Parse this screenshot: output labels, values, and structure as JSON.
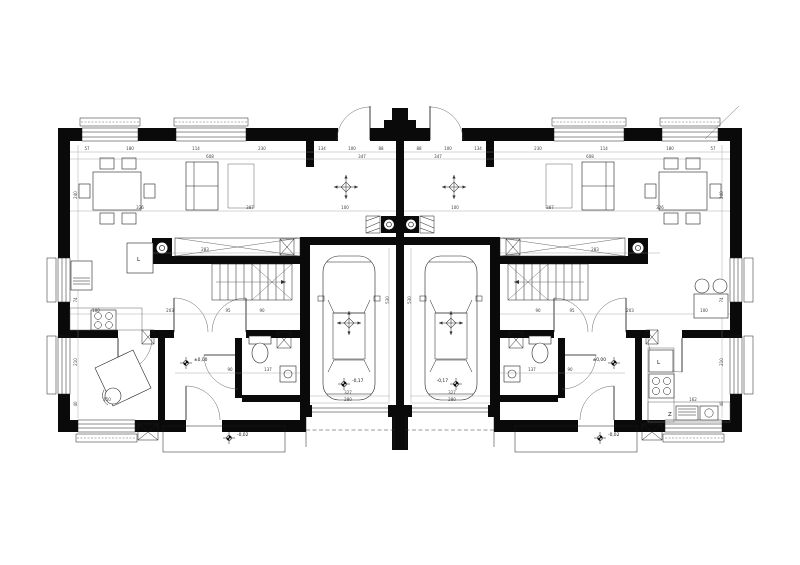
{
  "plan": {
    "labels": {
      "kitchen_cabinet_left": "L",
      "kitchen_cabinet_right": "L",
      "appliance_right": "Z"
    },
    "level_markers": [
      {
        "x": 186,
        "y": 363,
        "text": "±0,00",
        "side": "r"
      },
      {
        "x": 614,
        "y": 363,
        "text": "±0,00",
        "side": "l"
      },
      {
        "x": 229,
        "y": 438,
        "text": "-0,02",
        "side": "r"
      },
      {
        "x": 600,
        "y": 438,
        "text": "-0,02",
        "side": "r"
      },
      {
        "x": 344,
        "y": 384,
        "text": "-0,17",
        "side": "r"
      },
      {
        "x": 456,
        "y": 384,
        "text": "-0,17",
        "side": "l"
      }
    ],
    "dim_labels": [
      {
        "x": 87,
        "y": 150,
        "t": "57"
      },
      {
        "x": 130,
        "y": 150,
        "t": "180"
      },
      {
        "x": 196,
        "y": 150,
        "t": "114"
      },
      {
        "x": 262,
        "y": 150,
        "t": "230"
      },
      {
        "x": 322,
        "y": 150,
        "t": "134"
      },
      {
        "x": 352,
        "y": 150,
        "t": "100"
      },
      {
        "x": 381,
        "y": 150,
        "t": "88"
      },
      {
        "x": 419,
        "y": 150,
        "t": "88"
      },
      {
        "x": 448,
        "y": 150,
        "t": "100"
      },
      {
        "x": 478,
        "y": 150,
        "t": "134"
      },
      {
        "x": 538,
        "y": 150,
        "t": "230"
      },
      {
        "x": 604,
        "y": 150,
        "t": "114"
      },
      {
        "x": 670,
        "y": 150,
        "t": "180"
      },
      {
        "x": 713,
        "y": 150,
        "t": "57"
      },
      {
        "x": 210,
        "y": 158,
        "t": "608"
      },
      {
        "x": 362,
        "y": 158,
        "t": "347"
      },
      {
        "x": 438,
        "y": 158,
        "t": "347"
      },
      {
        "x": 590,
        "y": 158,
        "t": "608"
      },
      {
        "x": 140,
        "y": 209,
        "t": "326"
      },
      {
        "x": 250,
        "y": 209,
        "t": "387"
      },
      {
        "x": 345,
        "y": 209,
        "t": "100"
      },
      {
        "x": 455,
        "y": 209,
        "t": "100"
      },
      {
        "x": 550,
        "y": 209,
        "t": "387"
      },
      {
        "x": 660,
        "y": 209,
        "t": "326"
      },
      {
        "x": 205,
        "y": 251,
        "t": "283"
      },
      {
        "x": 595,
        "y": 251,
        "t": "283"
      },
      {
        "x": 96,
        "y": 312,
        "t": "100"
      },
      {
        "x": 170,
        "y": 312,
        "t": "203"
      },
      {
        "x": 228,
        "y": 312,
        "t": "95"
      },
      {
        "x": 262,
        "y": 312,
        "t": "90"
      },
      {
        "x": 538,
        "y": 312,
        "t": "90"
      },
      {
        "x": 572,
        "y": 312,
        "t": "95"
      },
      {
        "x": 630,
        "y": 312,
        "t": "203"
      },
      {
        "x": 704,
        "y": 312,
        "t": "100"
      },
      {
        "x": 230,
        "y": 371,
        "t": "90"
      },
      {
        "x": 268,
        "y": 371,
        "t": "137"
      },
      {
        "x": 532,
        "y": 371,
        "t": "137"
      },
      {
        "x": 570,
        "y": 371,
        "t": "90"
      },
      {
        "x": 107,
        "y": 401,
        "t": "150"
      },
      {
        "x": 693,
        "y": 401,
        "t": "162"
      },
      {
        "x": 348,
        "y": 394,
        "t": "327"
      },
      {
        "x": 452,
        "y": 394,
        "t": "327"
      },
      {
        "x": 348,
        "y": 401,
        "t": "280"
      },
      {
        "x": 452,
        "y": 401,
        "t": "280"
      },
      {
        "x": 77,
        "y": 195,
        "t": "240",
        "r": true
      },
      {
        "x": 77,
        "y": 300,
        "t": "74",
        "r": true
      },
      {
        "x": 77,
        "y": 362,
        "t": "210",
        "r": true
      },
      {
        "x": 77,
        "y": 404,
        "t": "40",
        "r": true
      },
      {
        "x": 723,
        "y": 195,
        "t": "240",
        "r": true
      },
      {
        "x": 723,
        "y": 300,
        "t": "74",
        "r": true
      },
      {
        "x": 723,
        "y": 362,
        "t": "210",
        "r": true
      },
      {
        "x": 723,
        "y": 404,
        "t": "40",
        "r": true
      },
      {
        "x": 389,
        "y": 300,
        "t": "530",
        "r": true
      },
      {
        "x": 411,
        "y": 300,
        "t": "530",
        "r": true
      }
    ]
  }
}
